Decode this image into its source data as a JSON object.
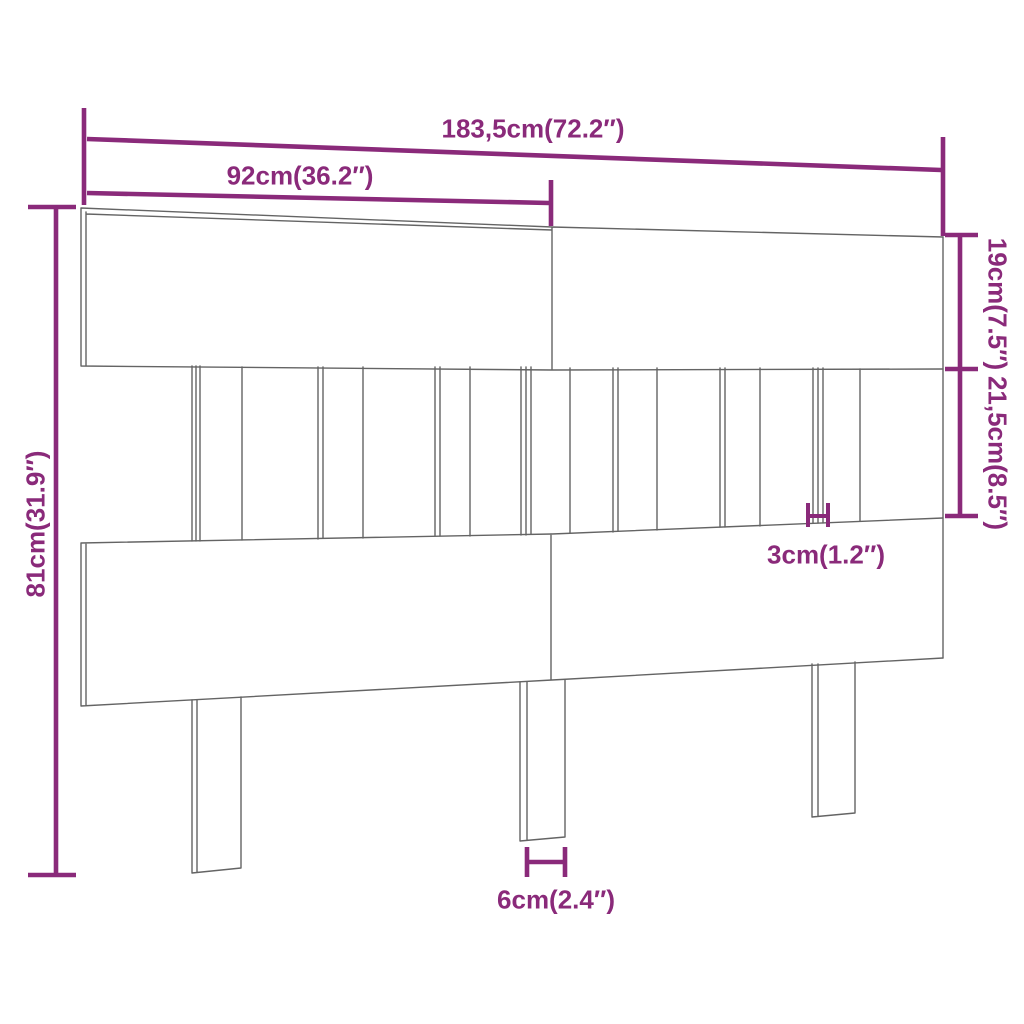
{
  "diagram": {
    "type": "product-dimension-diagram",
    "subject": "bed-headboard",
    "dimensions": {
      "total_width": "183,5cm(72.2″)",
      "panel_width": "92cm(36.2″)",
      "top_rail_height": "19cm(7.5″)",
      "slat_section_height": "21,5cm(8.5″)",
      "total_height": "81cm(31.9″)",
      "board_thickness": "3cm(1.2″)",
      "leg_width": "6cm(2.4″)"
    },
    "colors": {
      "accent": "#8A2A7A",
      "drawing_line": "#646464",
      "background": "#FFFFFF"
    }
  }
}
